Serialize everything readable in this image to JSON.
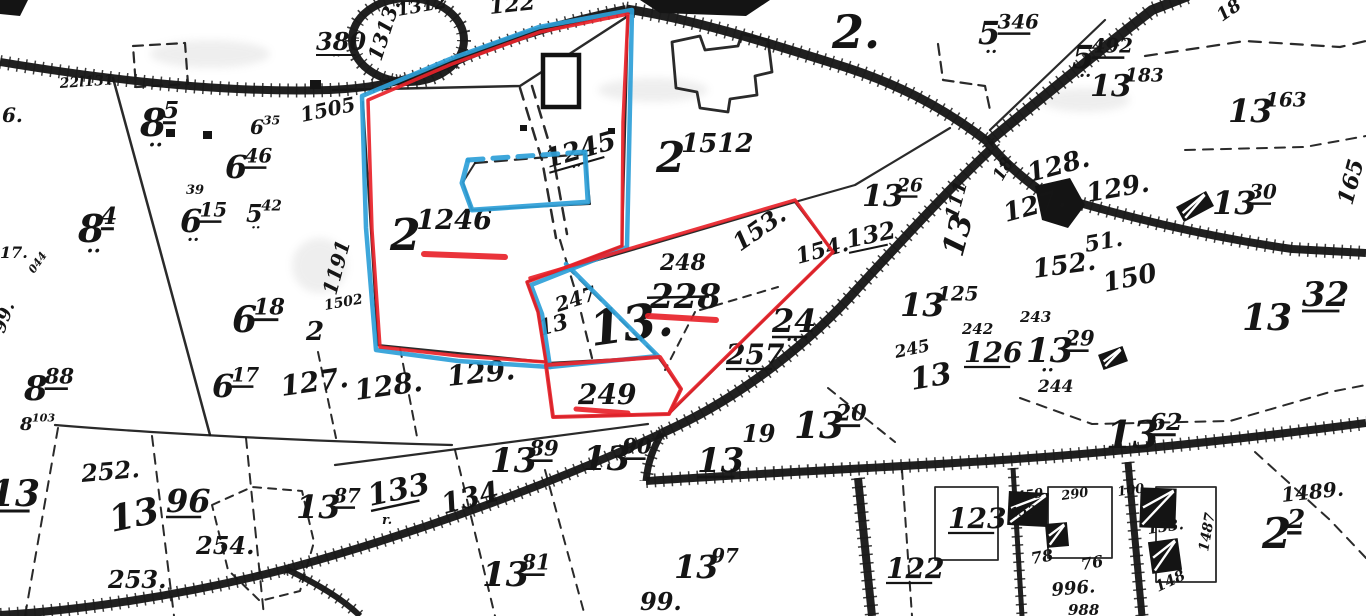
{
  "colors": {
    "paper": "#ffffff",
    "ink": "#161616",
    "red": "#e8232a",
    "blue": "#2e9fd8"
  },
  "map": {
    "labels": [
      {
        "t": "1313.",
        "x": 381,
        "y": 62,
        "s": 20,
        "r": -72
      },
      {
        "t": "1312",
        "x": 398,
        "y": 16,
        "s": 18,
        "r": -10
      },
      {
        "t": "122",
        "x": 490,
        "y": 14,
        "s": 22,
        "r": -6
      },
      {
        "t": "380",
        "x": 316,
        "y": 50,
        "s": 24,
        "u": 1,
        "dots": 1
      },
      {
        "t": "22l131",
        "x": 60,
        "y": 88,
        "s": 14,
        "r": -4
      },
      {
        "t": "6.",
        "x": 2,
        "y": 122,
        "s": 20
      },
      {
        "t": "8",
        "sup": "5",
        "x": 140,
        "y": 136,
        "s": 38,
        "u": 1,
        "dots": 1
      },
      {
        "t": "6",
        "sup": "46",
        "x": 225,
        "y": 178,
        "s": 32,
        "u": 1
      },
      {
        "t": "6",
        "sup": "35",
        "x": 250,
        "y": 134,
        "s": 20
      },
      {
        "t": "39",
        "x": 186,
        "y": 194,
        "s": 13
      },
      {
        "t": "6",
        "sup": "15",
        "x": 180,
        "y": 232,
        "s": 32,
        "u": 1,
        "dots": 1
      },
      {
        "t": "5",
        "sup": "42",
        "x": 246,
        "y": 222,
        "s": 24,
        "dots": 1
      },
      {
        "t": "8",
        "sup": "4",
        "x": 78,
        "y": 242,
        "s": 38,
        "u": 1,
        "dots": 1
      },
      {
        "t": "17.",
        "x": 0,
        "y": 258,
        "s": 16
      },
      {
        "t": "044",
        "x": 34,
        "y": 274,
        "s": 11,
        "r": -55
      },
      {
        "t": "99.",
        "x": 4,
        "y": 334,
        "s": 18,
        "r": -70
      },
      {
        "t": "6",
        "sup": "18",
        "x": 232,
        "y": 332,
        "s": 36,
        "u": 1
      },
      {
        "t": "2",
        "x": 306,
        "y": 340,
        "s": 26
      },
      {
        "t": "1505",
        "x": 302,
        "y": 122,
        "s": 20,
        "r": -12
      },
      {
        "t": "1191",
        "x": 336,
        "y": 296,
        "s": 20,
        "r": -75
      },
      {
        "t": "1502",
        "x": 325,
        "y": 310,
        "s": 14,
        "r": -10
      },
      {
        "t": "6",
        "sup": "17",
        "x": 212,
        "y": 397,
        "s": 32,
        "u": 1
      },
      {
        "t": "127.",
        "x": 282,
        "y": 396,
        "s": 28,
        "r": -8
      },
      {
        "t": "128.",
        "x": 356,
        "y": 400,
        "s": 28,
        "r": -8
      },
      {
        "t": "129.",
        "x": 448,
        "y": 386,
        "s": 28,
        "r": -6
      },
      {
        "t": "8",
        "sup": "88",
        "x": 24,
        "y": 400,
        "s": 34,
        "u": 1
      },
      {
        "t": "8",
        "sup": "103",
        "x": 20,
        "y": 430,
        "s": 18
      },
      {
        "t": "2",
        "sup": "1246",
        "x": 390,
        "y": 250,
        "s": 44
      },
      {
        "t": "1245",
        "x": 548,
        "y": 168,
        "s": 26,
        "r": -16,
        "u": 1,
        "dots": 1
      },
      {
        "t": "247",
        "x": 558,
        "y": 312,
        "s": 20,
        "r": -18
      },
      {
        "t": "13",
        "x": 540,
        "y": 336,
        "s": 22,
        "r": -15
      },
      {
        "t": "13.",
        "x": 592,
        "y": 346,
        "s": 48,
        "r": -8
      },
      {
        "t": "248",
        "x": 660,
        "y": 270,
        "s": 22
      },
      {
        "t": "228",
        "x": 650,
        "y": 308,
        "s": 34,
        "strike": 1
      },
      {
        "t": "153.",
        "x": 740,
        "y": 252,
        "s": 24,
        "r": -35
      },
      {
        "t": "154.",
        "x": 798,
        "y": 264,
        "s": 22,
        "r": -15
      },
      {
        "t": "24",
        "x": 772,
        "y": 332,
        "s": 32,
        "u": 1,
        "dots": 1
      },
      {
        "t": "257",
        "x": 726,
        "y": 364,
        "s": 28,
        "u": 1,
        "dots": 1
      },
      {
        "t": "249",
        "x": 578,
        "y": 404,
        "s": 28
      },
      {
        "t": "2",
        "sup": "1512",
        "x": 656,
        "y": 172,
        "s": 42
      },
      {
        "t": "2.",
        "x": 832,
        "y": 48,
        "s": 46
      },
      {
        "t": "5",
        "sup": "346",
        "x": 978,
        "y": 44,
        "s": 32,
        "u": 1,
        "dots": 1
      },
      {
        "t": "5",
        "sup": "492",
        "x": 1072,
        "y": 68,
        "s": 32,
        "u": 1,
        "dots": 1
      },
      {
        "t": "13",
        "sup": "183",
        "x": 1090,
        "y": 96,
        "s": 30
      },
      {
        "t": "18",
        "x": 1222,
        "y": 22,
        "s": 18,
        "r": -35
      },
      {
        "t": "13",
        "sup": "163",
        "x": 1228,
        "y": 122,
        "s": 32
      },
      {
        "t": "13",
        "sup": "30",
        "x": 1212,
        "y": 214,
        "s": 32,
        "u": 1
      },
      {
        "t": "165",
        "x": 1352,
        "y": 206,
        "s": 22,
        "r": -75
      },
      {
        "t": "13",
        "sup": "26",
        "x": 862,
        "y": 206,
        "s": 30,
        "u": 1
      },
      {
        "t": "132",
        "x": 848,
        "y": 248,
        "s": 24,
        "r": -12,
        "u": 1
      },
      {
        "t": "18",
        "x": 1002,
        "y": 182,
        "s": 17,
        "r": -60
      },
      {
        "t": "13",
        "sup": "111",
        "x": 962,
        "y": 258,
        "s": 30,
        "r": -75
      },
      {
        "t": "128.",
        "x": 1030,
        "y": 182,
        "s": 26,
        "r": -15
      },
      {
        "t": "129.",
        "x": 1088,
        "y": 202,
        "s": 26,
        "r": -10
      },
      {
        "t": "127.",
        "x": 1006,
        "y": 222,
        "s": 26,
        "r": -15
      },
      {
        "t": "51.",
        "x": 1086,
        "y": 252,
        "s": 22,
        "r": -10
      },
      {
        "t": "152.",
        "x": 1034,
        "y": 278,
        "s": 26,
        "r": -8
      },
      {
        "t": "150",
        "x": 1105,
        "y": 292,
        "s": 26,
        "r": -12
      },
      {
        "t": "13",
        "sup": "125",
        "x": 900,
        "y": 316,
        "s": 32
      },
      {
        "t": "13",
        "x": 1242,
        "y": 330,
        "s": 36
      },
      {
        "t": "32",
        "x": 1302,
        "y": 306,
        "s": 34,
        "u": 1
      },
      {
        "t": "245",
        "x": 896,
        "y": 358,
        "s": 17,
        "r": -12
      },
      {
        "t": "13",
        "x": 912,
        "y": 390,
        "s": 30,
        "r": -10
      },
      {
        "t": "242",
        "x": 962,
        "y": 334,
        "s": 15
      },
      {
        "t": "243",
        "x": 1020,
        "y": 322,
        "s": 15
      },
      {
        "t": "126",
        "x": 964,
        "y": 362,
        "s": 28,
        "u": 1
      },
      {
        "t": "13",
        "sup": "29",
        "x": 1026,
        "y": 362,
        "s": 34,
        "u": 1,
        "dots": 1
      },
      {
        "t": "244",
        "x": 1038,
        "y": 392,
        "s": 17
      },
      {
        "t": "13",
        "x": 697,
        "y": 472,
        "s": 34,
        "u": 1
      },
      {
        "t": "19",
        "x": 742,
        "y": 442,
        "s": 24
      },
      {
        "t": "13",
        "sup": "20",
        "x": 794,
        "y": 438,
        "s": 36,
        "u": 1
      },
      {
        "t": "13",
        "sup": "62",
        "x": 1106,
        "y": 448,
        "s": 38,
        "u": 1
      },
      {
        "t": "1489.",
        "x": 1282,
        "y": 502,
        "s": 20,
        "r": -6
      },
      {
        "t": "2",
        "sup": "2",
        "x": 1262,
        "y": 548,
        "s": 42,
        "u": 1
      },
      {
        "t": "13",
        "sup": "97",
        "x": 674,
        "y": 578,
        "s": 32
      },
      {
        "t": "122",
        "x": 886,
        "y": 578,
        "s": 28,
        "u": 1
      },
      {
        "t": "123",
        "x": 948,
        "y": 528,
        "s": 28,
        "u": 1
      },
      {
        "t": "99.",
        "x": 640,
        "y": 610,
        "s": 24
      },
      {
        "t": "13",
        "sup": "89",
        "x": 490,
        "y": 472,
        "s": 34,
        "u": 1
      },
      {
        "t": "13",
        "sup": "90",
        "x": 583,
        "y": 470,
        "s": 34,
        "u": 1
      },
      {
        "t": "13",
        "sup": "81",
        "x": 482,
        "y": 586,
        "s": 34,
        "u": 1
      },
      {
        "t": "13",
        "sup": "87",
        "x": 296,
        "y": 518,
        "s": 32,
        "u": 1
      },
      {
        "t": "133",
        "x": 370,
        "y": 506,
        "s": 30,
        "r": -12,
        "u": 1
      },
      {
        "t": "r.",
        "x": 382,
        "y": 524,
        "s": 13
      },
      {
        "t": "134",
        "x": 444,
        "y": 514,
        "s": 28,
        "r": -14
      },
      {
        "t": "252.",
        "x": 82,
        "y": 482,
        "s": 24,
        "r": -5
      },
      {
        "t": "13",
        "x": 112,
        "y": 532,
        "s": 36,
        "r": -12
      },
      {
        "t": "96",
        "x": 166,
        "y": 512,
        "s": 32,
        "u": 1
      },
      {
        "t": "254.",
        "x": 196,
        "y": 554,
        "s": 24
      },
      {
        "t": "253.",
        "x": 108,
        "y": 588,
        "s": 24
      },
      {
        "t": "13",
        "x": -10,
        "y": 506,
        "s": 36,
        "u": 1
      },
      {
        "t": "1459",
        "x": 1008,
        "y": 502,
        "s": 13,
        "r": -8
      },
      {
        "t": "1527",
        "x": 1010,
        "y": 517,
        "s": 13,
        "r": -5
      },
      {
        "t": "290",
        "x": 1062,
        "y": 500,
        "s": 13,
        "r": -8
      },
      {
        "t": "100",
        "x": 1118,
        "y": 496,
        "s": 13,
        "r": -8
      },
      {
        "t": "153.",
        "x": 1148,
        "y": 534,
        "s": 15,
        "r": -8
      },
      {
        "t": "1487",
        "x": 1208,
        "y": 552,
        "s": 14,
        "r": -80
      },
      {
        "t": "78",
        "x": 1032,
        "y": 564,
        "s": 16,
        "r": -10
      },
      {
        "t": "76",
        "x": 1082,
        "y": 570,
        "s": 16,
        "r": -10
      },
      {
        "t": "996.",
        "x": 1052,
        "y": 596,
        "s": 18,
        "r": -5
      },
      {
        "t": "988",
        "x": 1068,
        "y": 615,
        "s": 15
      },
      {
        "t": "148",
        "x": 1158,
        "y": 592,
        "s": 15,
        "r": -25
      }
    ],
    "roads": [
      {
        "d": "M 0,62 C 120,82 230,93 330,90 C 382,88 422,77 466,57 C 506,40 562,22 626,9",
        "w": 8
      },
      {
        "d": "M 352,40 a 56,42 0 1 0 112,0 a 56,42 0 1 0 -112,0",
        "w": 8
      },
      {
        "d": "M 626,9 C 692,19 762,41 832,63 C 892,81 942,106 988,142",
        "w": 9
      },
      {
        "d": "M 988,142 C 1032,106 1092,56 1152,10 L 1188,-4",
        "w": 10
      },
      {
        "d": "M 1042,192 C 1122,216 1202,236 1292,249 L 1366,253",
        "w": 8
      },
      {
        "d": "M 990,150 C 952,186 906,236 858,288 C 816,336 746,396 662,433",
        "w": 9
      },
      {
        "d": "M 662,433 C 562,479 432,529 286,569 C 178,597 72,611 0,615",
        "w": 8
      },
      {
        "d": "M 286,569 C 320,585 344,600 360,616",
        "w": 6
      },
      {
        "d": "M 662,433 C 653,448 648,462 646,481",
        "w": 7
      },
      {
        "d": "M 646,481 C 762,473 882,468 1002,460 C 1122,452 1252,438 1366,423",
        "w": 8
      },
      {
        "d": "M 858,478 L 872,616",
        "w": 8
      },
      {
        "d": "M 1128,462 L 1142,616",
        "w": 7
      },
      {
        "d": "M 1013,468 L 1022,616",
        "w": 5
      },
      {
        "d": "M 988,142 C 1000,158 1020,176 1042,192",
        "w": 9
      }
    ],
    "lines": [
      {
        "d": "M 113,78 L 160,250 L 210,435",
        "w": 2.5
      },
      {
        "d": "M 55,425 C 150,433 300,441 452,445",
        "w": 2.2
      },
      {
        "d": "M 318,352 L 336,438",
        "w": 2,
        "dash": "9 7"
      },
      {
        "d": "M 400,348 L 418,442",
        "w": 2,
        "dash": "9 7"
      },
      {
        "d": "M 58,428 L 25,616",
        "w": 2,
        "dash": "10 8"
      },
      {
        "d": "M 152,436 L 174,616",
        "w": 2,
        "dash": "10 8"
      },
      {
        "d": "M 246,438 L 264,616",
        "w": 2,
        "dash": "10 8"
      },
      {
        "d": "M 212,505 L 252,487 L 302,491 L 314,542 L 300,591 L 260,601 L 228,570 Z",
        "w": 2,
        "dash": "8 7"
      },
      {
        "d": "M 333,90 L 520,86 L 628,16",
        "w": 2.5
      },
      {
        "d": "M 363,102 L 378,345",
        "w": 2.2
      },
      {
        "d": "M 378,345 L 546,362",
        "w": 2.2
      },
      {
        "d": "M 628,16 L 622,246",
        "w": 2.2
      },
      {
        "d": "M 622,246 L 527,282 L 538,312 L 546,363",
        "w": 2.2
      },
      {
        "d": "M 520,88 L 542,160 L 556,238",
        "w": 2.5,
        "dash": "12 9"
      },
      {
        "d": "M 532,86 L 553,156 L 567,234",
        "w": 2.5,
        "dash": "12 9"
      },
      {
        "d": "M 560,240 L 578,300 L 592,358",
        "w": 2.2,
        "dash": "10 9"
      },
      {
        "d": "M 475,163 L 585,154",
        "w": 2.2,
        "dash": "12 8"
      },
      {
        "d": "M 585,154 L 590,204 L 472,210 L 463,182 L 475,163",
        "w": 2
      },
      {
        "d": "M 950,128 L 855,185 L 795,202 L 530,280",
        "w": 2.2
      },
      {
        "d": "M 795,202 L 833,252 L 670,413",
        "w": 2.2
      },
      {
        "d": "M 546,363 L 658,357 L 681,389 L 669,414 L 553,417 Z",
        "w": 2
      },
      {
        "d": "M 566,266 L 656,355",
        "w": 2.2,
        "dash": "11 8"
      },
      {
        "d": "M 695,312 L 665,370",
        "w": 2,
        "dash": "8 7"
      },
      {
        "d": "M 700,310 L 778,287",
        "w": 2,
        "dash": "8 7"
      },
      {
        "d": "M 828,388 L 895,442",
        "w": 2,
        "dash": "9 7"
      },
      {
        "d": "M 335,465 L 648,424",
        "w": 2.2
      },
      {
        "d": "M 455,450 L 495,616",
        "w": 2,
        "dash": "9 8"
      },
      {
        "d": "M 545,470 L 585,616",
        "w": 2,
        "dash": "9 8"
      },
      {
        "d": "M 1020,398 L 1092,424 L 1230,421 L 1330,392 L 1366,385",
        "w": 2,
        "dash": "10 8"
      },
      {
        "d": "M 1255,452 L 1330,520 L 1366,558",
        "w": 2,
        "dash": "10 8"
      },
      {
        "d": "M 1145,56 L 1245,41 L 1340,47 L 1366,41",
        "w": 2.2,
        "dash": "12 9"
      },
      {
        "d": "M 1185,150 L 1305,147 L 1366,136",
        "w": 2,
        "dash": "10 8"
      },
      {
        "d": "M 1105,20 L 990,130",
        "w": 2.2
      },
      {
        "d": "M 938,44 L 943,80 L 985,86 L 990,110",
        "w": 2.2,
        "dash": "11 7"
      },
      {
        "d": "M 133,46 L 185,43 L 188,84 L 136,87 Z",
        "w": 2.2,
        "dash": "10 7"
      },
      {
        "d": "M 902,470 L 912,616",
        "w": 2,
        "dash": "9 7"
      },
      {
        "d": "M 935,487 L 998,487 L 998,560 L 935,560 Z",
        "w": 1.8
      },
      {
        "d": "M 1048,487 L 1112,487 L 1112,558 L 1048,558 Z",
        "w": 1.8
      },
      {
        "d": "M 1156,487 L 1216,487 L 1216,582 L 1156,582 Z",
        "w": 1.8
      },
      {
        "d": "M 672,42 L 700,36 L 705,50 L 738,46 L 742,34 L 768,40 L 772,72 L 755,76 L 757,95 L 730,99 L 728,112 L 700,108 L 697,92 L 676,88 Z",
        "w": 2.8
      }
    ],
    "buildings": [
      {
        "type": "rect",
        "x": 543,
        "y": 55,
        "w": 36,
        "h": 52,
        "outline": 1,
        "sw": 4.5
      },
      {
        "type": "rect",
        "x": 166,
        "y": 129,
        "w": 9,
        "h": 8
      },
      {
        "type": "rect",
        "x": 203,
        "y": 131,
        "w": 9,
        "h": 8
      },
      {
        "type": "rect",
        "x": 310,
        "y": 80,
        "w": 11,
        "h": 9
      },
      {
        "type": "rect",
        "x": 520,
        "y": 125,
        "w": 7,
        "h": 6
      },
      {
        "type": "rect",
        "x": 608,
        "y": 128,
        "w": 7,
        "h": 6
      },
      {
        "type": "poly",
        "d": "M 0,0 L 28,0 L 20,16 L 0,14 Z"
      },
      {
        "type": "poly",
        "d": "M 640,0 L 770,0 L 746,16 L 660,13 Z"
      },
      {
        "type": "poly",
        "d": "M 1035,186 L 1070,178 L 1085,205 L 1068,228 L 1042,220 Z"
      },
      {
        "type": "rect",
        "x": 1008,
        "y": 492,
        "w": 40,
        "h": 34,
        "rot": 3,
        "hatch": 1
      },
      {
        "type": "rect",
        "x": 1046,
        "y": 523,
        "w": 22,
        "h": 24,
        "rot": -5,
        "hatch": 1
      },
      {
        "type": "rect",
        "x": 1140,
        "y": 488,
        "w": 36,
        "h": 40,
        "rot": 2,
        "hatch": 1
      },
      {
        "type": "rect",
        "x": 1150,
        "y": 540,
        "w": 30,
        "h": 32,
        "rot": -8,
        "hatch": 1
      },
      {
        "type": "rect",
        "x": 1178,
        "y": 198,
        "w": 34,
        "h": 17,
        "rot": -28,
        "hatch": 1
      },
      {
        "type": "rect",
        "x": 1100,
        "y": 350,
        "w": 26,
        "h": 16,
        "rot": -20,
        "hatch": 1
      }
    ],
    "overlays": {
      "blue": [
        {
          "d": "M 362,96 L 450,59 L 539,27 L 632,10 L 627,247 L 531,285 L 542,314 L 550,367 L 458,361 L 376,350 L 366,228 Z",
          "w": 4.5
        },
        {
          "d": "M 566,264 L 658,356 L 550,367",
          "w": 4.5
        },
        {
          "d": "M 468,160 L 462,183 L 472,210 L 588,202 L 585,152",
          "w": 5
        },
        {
          "d": "M 468,160 L 585,152",
          "w": 5,
          "dash": "15 10"
        }
      ],
      "red": [
        {
          "d": "M 368,100 L 452,64 L 540,32 L 628,14 L 623,122 L 622,246 L 527,282 L 538,312 L 546,362 L 460,356 L 380,347 L 372,230 Z",
          "w": 3.5
        },
        {
          "d": "M 530,278 L 795,200 L 833,252 L 670,412",
          "w": 3.5
        },
        {
          "d": "M 546,365 L 660,357 L 681,389 L 669,414 L 553,417 Z",
          "w": 4
        },
        {
          "d": "M 424,254 L 505,257",
          "w": 6
        },
        {
          "d": "M 648,316 L 716,320",
          "w": 6
        },
        {
          "d": "M 576,409 L 628,413",
          "w": 5
        }
      ]
    },
    "smudges": [
      {
        "x": 150,
        "y": 40,
        "w": 120,
        "h": 28
      },
      {
        "x": 598,
        "y": 78,
        "w": 110,
        "h": 24
      },
      {
        "x": 1040,
        "y": 88,
        "w": 90,
        "h": 24
      },
      {
        "x": 292,
        "y": 238,
        "w": 55,
        "h": 55
      }
    ]
  }
}
